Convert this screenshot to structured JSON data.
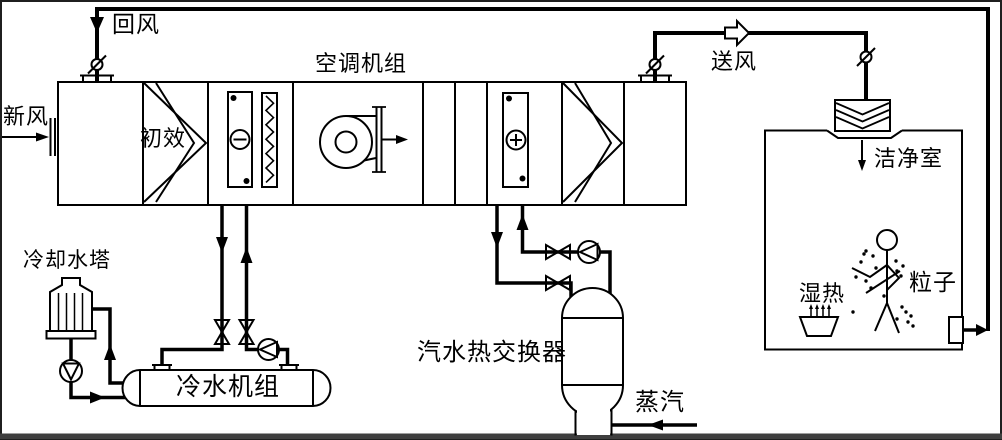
{
  "colors": {
    "line": "#000000",
    "background": "#ffffff",
    "frame": "#2e2e2e"
  },
  "labels": {
    "return_air": "回风",
    "fresh_air": "新风",
    "ahu": "空调机组",
    "pre_filter": "初效",
    "supply_air": "送风",
    "clean_room": "洁净室",
    "cooling_tower": "冷却水塔",
    "chiller": "冷水机组",
    "heat_exchanger": "汽水热交换器",
    "steam": "蒸汽",
    "humid_heat": "湿热",
    "particles": "粒子"
  }
}
